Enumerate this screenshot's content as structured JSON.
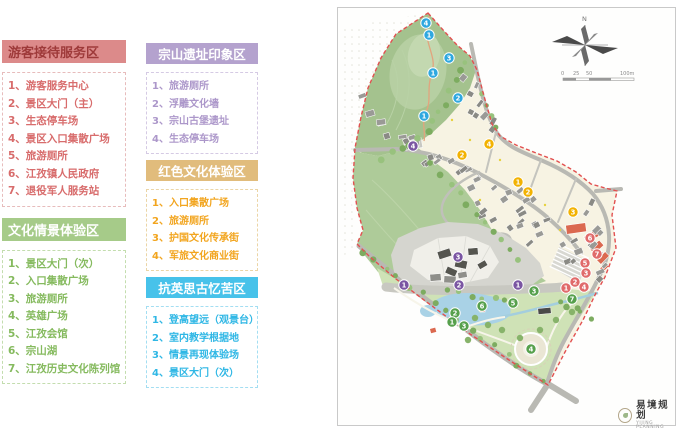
{
  "legend": {
    "sections": [
      {
        "id": "visitor-service",
        "title": "游客接待服务区",
        "header_bg": "#DC8A8A",
        "header_text": "#9E3A3A",
        "item_color": "#D86C6C",
        "border_color": "#E7BCBC",
        "items": [
          "游客服务中心",
          "景区大门（主）",
          "生态停车场",
          "景区入口集散广场",
          "旅游厕所",
          "江孜镇人民政府",
          "退役军人服务站"
        ]
      },
      {
        "id": "culture-scene",
        "title": "文化情景体验区",
        "header_bg": "#A6CB89",
        "header_text": "#FFFFFF",
        "item_color": "#85BA5E",
        "border_color": "#C3DDAE",
        "items": [
          "景区大门（次）",
          "入口集散广场",
          "旅游厕所",
          "英雄广场",
          "江孜会馆",
          "宗山湖",
          "江孜历史文化陈列馆"
        ]
      },
      {
        "id": "zongshan-impression",
        "title": "宗山遗址印象区",
        "header_bg": "#B4A2CE",
        "header_text": "#FFFFFF",
        "item_color": "#AC97CA",
        "border_color": "#D5CAE4",
        "items": [
          "旅游厕所",
          "浮雕文化墙",
          "宗山古堡遗址",
          "生态停车场"
        ]
      },
      {
        "id": "red-culture",
        "title": "红色文化体验区",
        "header_bg": "#E1BC7C",
        "header_text": "#FFFFFF",
        "item_color": "#F2A51F",
        "border_color": "#EBD5A6",
        "items": [
          "入口集散广场",
          "旅游厕所",
          "护国文化传承街",
          "军旅文化商业街"
        ]
      },
      {
        "id": "anti-british",
        "title": "抗英思古忆苦区",
        "header_bg": "#47C2EA",
        "header_text": "#FFFFFF",
        "item_color": "#2FB7E5",
        "border_color": "#A3DEF2",
        "items": [
          "登高望远（观景台）",
          "室内教学根据地",
          "情景再现体验场",
          "景区大门（次）"
        ]
      }
    ]
  },
  "map": {
    "north_label": "N",
    "scale_labels": [
      "0",
      "25",
      "50",
      "100m"
    ],
    "logo_cn": "易境规划",
    "logo_en": "YIJING PLANNING",
    "marker_colors": {
      "blue": "#2FA8DF",
      "purple": "#7A55A2",
      "yellow": "#F2B202",
      "red": "#E06A6A",
      "green": "#56A04C"
    },
    "palette": {
      "boundary": "#E25050",
      "hill_green": "#A4C28E",
      "slope_green": "#AECB99",
      "park_green": "#CFE2B6",
      "village_cream": "#F7F3E3",
      "road_gray": "#B9B9B3",
      "mountain_gray": "#D5D5CF",
      "cliff_white": "#F0EFE9",
      "lake_blue": "#A9D2E6",
      "roof_red": "#DB6950"
    },
    "markers": [
      {
        "c": "blue",
        "n": "4",
        "x": 426,
        "y": 23
      },
      {
        "c": "blue",
        "n": "1",
        "x": 429,
        "y": 35
      },
      {
        "c": "blue",
        "n": "3",
        "x": 449,
        "y": 58
      },
      {
        "c": "blue",
        "n": "1",
        "x": 433,
        "y": 73
      },
      {
        "c": "blue",
        "n": "2",
        "x": 458,
        "y": 98
      },
      {
        "c": "blue",
        "n": "1",
        "x": 424,
        "y": 116
      },
      {
        "c": "purple",
        "n": "4",
        "x": 413,
        "y": 146
      },
      {
        "c": "purple",
        "n": "3",
        "x": 458,
        "y": 257
      },
      {
        "c": "purple",
        "n": "1",
        "x": 404,
        "y": 285
      },
      {
        "c": "purple",
        "n": "2",
        "x": 459,
        "y": 285
      },
      {
        "c": "purple",
        "n": "1",
        "x": 518,
        "y": 285
      },
      {
        "c": "yellow",
        "n": "4",
        "x": 489,
        "y": 144
      },
      {
        "c": "yellow",
        "n": "2",
        "x": 462,
        "y": 155
      },
      {
        "c": "yellow",
        "n": "1",
        "x": 518,
        "y": 182
      },
      {
        "c": "yellow",
        "n": "2",
        "x": 528,
        "y": 192
      },
      {
        "c": "yellow",
        "n": "3",
        "x": 573,
        "y": 212
      },
      {
        "c": "red",
        "n": "6",
        "x": 590,
        "y": 238
      },
      {
        "c": "red",
        "n": "7",
        "x": 597,
        "y": 254
      },
      {
        "c": "red",
        "n": "5",
        "x": 585,
        "y": 263
      },
      {
        "c": "red",
        "n": "3",
        "x": 586,
        "y": 273
      },
      {
        "c": "red",
        "n": "2",
        "x": 575,
        "y": 282
      },
      {
        "c": "red",
        "n": "4",
        "x": 584,
        "y": 287
      },
      {
        "c": "red",
        "n": "1",
        "x": 566,
        "y": 288
      },
      {
        "c": "green",
        "n": "3",
        "x": 534,
        "y": 291
      },
      {
        "c": "green",
        "n": "7",
        "x": 572,
        "y": 299
      },
      {
        "c": "green",
        "n": "5",
        "x": 513,
        "y": 303
      },
      {
        "c": "green",
        "n": "6",
        "x": 482,
        "y": 306
      },
      {
        "c": "green",
        "n": "2",
        "x": 455,
        "y": 313
      },
      {
        "c": "green",
        "n": "1",
        "x": 452,
        "y": 322
      },
      {
        "c": "green",
        "n": "3",
        "x": 464,
        "y": 326
      },
      {
        "c": "green",
        "n": "4",
        "x": 531,
        "y": 349
      }
    ]
  }
}
